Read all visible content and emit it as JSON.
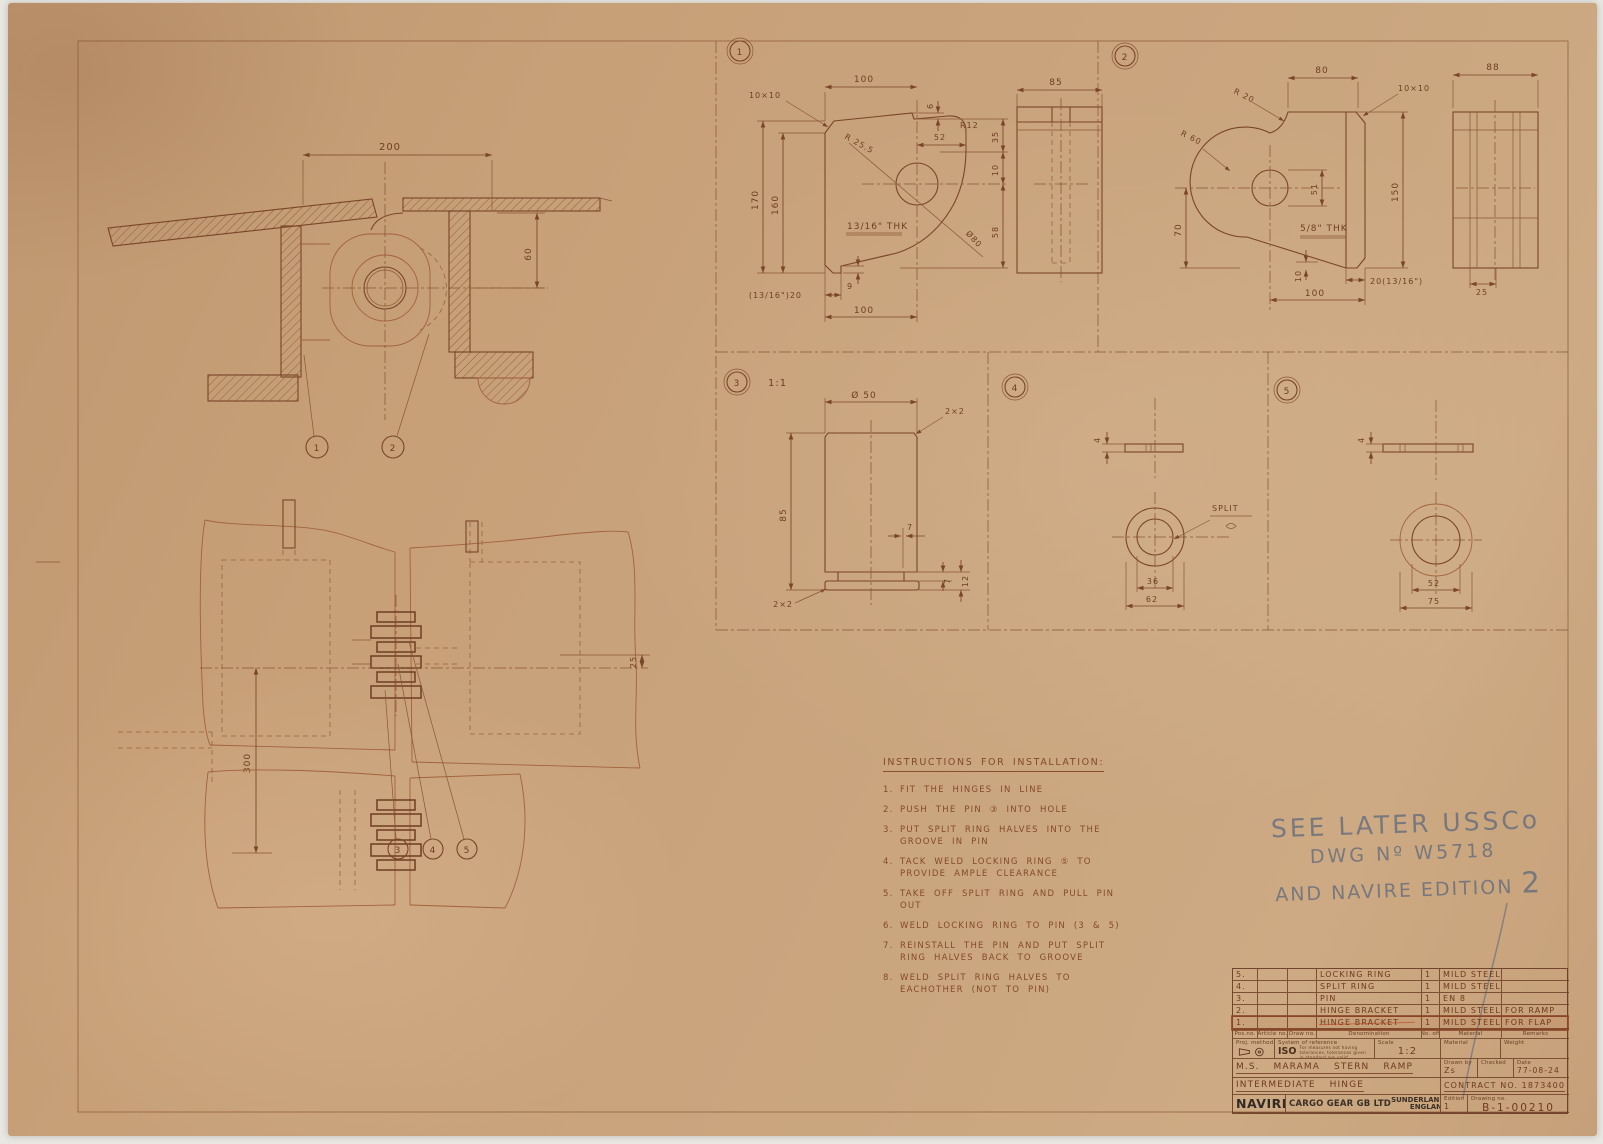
{
  "palette": {
    "paper": "#c7a078",
    "ink": "#7a4528",
    "red_line": "#a3623c",
    "pencil": "#74777f"
  },
  "assembly_side": {
    "dim_width": "200",
    "dim_height": "60",
    "balloon_flap": "1",
    "balloon_ramp": "2"
  },
  "assembly_plan": {
    "dim_pitch": "300",
    "dim_offset": "25",
    "balloon_pin": "3",
    "balloon_split_ring": "4",
    "balloon_locking_ring": "5"
  },
  "detail_1": {
    "label": "1",
    "dim_top_width": "100",
    "chamfer": "10×10",
    "dim_height_outer": "170",
    "dim_height_inner": "160",
    "radius_bore": "R 25.5",
    "dim_52": "52",
    "dim_6": "6",
    "radius_corner": "R12",
    "dim_35": "35",
    "dim_10": "10",
    "dim_58": "58",
    "thickness": "13/16\" THK",
    "dia_sweep": "Ø80",
    "dim_9": "9",
    "dim_step": "(13/16\")20",
    "dim_bottom_width": "100",
    "side_width": "85"
  },
  "detail_2": {
    "label": "2",
    "dim_top_width": "80",
    "radius_r20": "R 20",
    "radius_r60": "R 60",
    "chamfer": "10×10",
    "dim_bore": "51",
    "dim_height_left": "70",
    "dim_height_right": "150",
    "thickness": "5/8\" THK",
    "dim_step": "10",
    "dim_step2": "20(13/16\")",
    "dim_bottom_width": "100",
    "side_width": "88",
    "side_step": "25"
  },
  "detail_3": {
    "label": "3",
    "scale": "1:1",
    "dia_top": "Ø 50",
    "chamfer_top": "2×2",
    "dim_height": "85",
    "dim_groove_width": "7",
    "dim_groove_depth": "7",
    "dim_collar": "12",
    "chamfer_bottom": "2×2"
  },
  "detail_4": {
    "label": "4",
    "dim_thickness": "4",
    "split_label": "SPLIT",
    "dim_inner": "36",
    "dim_outer": "62"
  },
  "detail_5": {
    "label": "5",
    "dim_thickness": "4",
    "dim_inner": "52",
    "dim_outer": "75"
  },
  "instructions": {
    "title": "INSTRUCTIONS FOR INSTALLATION:",
    "items": [
      {
        "no": "1.",
        "text": "FIT THE HINGES IN LINE"
      },
      {
        "no": "2.",
        "text": "PUSH THE PIN ③ INTO HOLE"
      },
      {
        "no": "3.",
        "text": "PUT SPLIT RING HALVES INTO THE GROOVE IN PIN"
      },
      {
        "no": "4.",
        "text": "TACK WELD LOCKING RING ⑤ TO PROVIDE AMPLE CLEARANCE"
      },
      {
        "no": "5.",
        "text": "TAKE OFF SPLIT RING AND PULL PIN OUT"
      },
      {
        "no": "6.",
        "text": "WELD LOCKING RING TO PIN (3 & 5)"
      },
      {
        "no": "7.",
        "text": "REINSTALL THE PIN AND PUT SPLIT RING HALVES BACK TO GROOVE"
      },
      {
        "no": "8.",
        "text": "WELD SPLIT RING HALVES TO EACHOTHER (NOT TO PIN)"
      }
    ]
  },
  "pencil_note": {
    "line1": "SEE LATER USSCo",
    "line2": "DWG Nº W5718",
    "line3": "AND NAVIRE EDITION",
    "line3_num": "2"
  },
  "title_block": {
    "parts": [
      {
        "pos": "5.",
        "denomination": "LOCKING RING",
        "qty": "1",
        "material": "MILD STEEL",
        "remarks": ""
      },
      {
        "pos": "4.",
        "denomination": "SPLIT RING",
        "qty": "1",
        "material": "MILD STEEL",
        "remarks": ""
      },
      {
        "pos": "3.",
        "denomination": "PIN",
        "qty": "1",
        "material": "EN 8",
        "remarks": ""
      },
      {
        "pos": "2.",
        "denomination": "HINGE BRACKET",
        "qty": "1",
        "material": "MILD STEEL",
        "remarks": "FOR RAMP"
      },
      {
        "pos": "1.",
        "denomination": "HINGE BRACKET",
        "qty": "1",
        "material": "MILD STEEL",
        "remarks": "FOR FLAP"
      }
    ],
    "headers": {
      "pos": "Pos.no.",
      "article": "Article no.",
      "draw": "Draw no.",
      "denomination": "Denomination",
      "qty": "No. off",
      "material": "Material",
      "remarks": "Remarks"
    },
    "ref": {
      "proj_label": "Proj. method",
      "system_label": "System of reference",
      "iso": "ISO",
      "iso_note": "For measures not having tolerances, tolerances given in standard are valid",
      "scale_label": "Scale",
      "scale_value": "1:2",
      "material_label": "Material",
      "weight_label": "Weight"
    },
    "title_row": {
      "project": "M.S. MARAMA STERN RAMP",
      "drawn_label": "Drawn by",
      "drawn_value": "Zs",
      "checked_label": "Checked",
      "date_label": "Date",
      "date_value": "77-08-24"
    },
    "sub_row": {
      "title": "INTERMEDIATE HINGE",
      "contract": "CONTRACT NO. 1873400"
    },
    "footer": {
      "brand": "NAVIRE",
      "company": "CARGO GEAR GB LTD",
      "city": "SUNDERLAND,",
      "country": "ENGLAND",
      "edition_label": "Edition",
      "edition_value": "1",
      "drawing_label": "Drawing no.",
      "drawing_value": "B-1-00210"
    }
  }
}
